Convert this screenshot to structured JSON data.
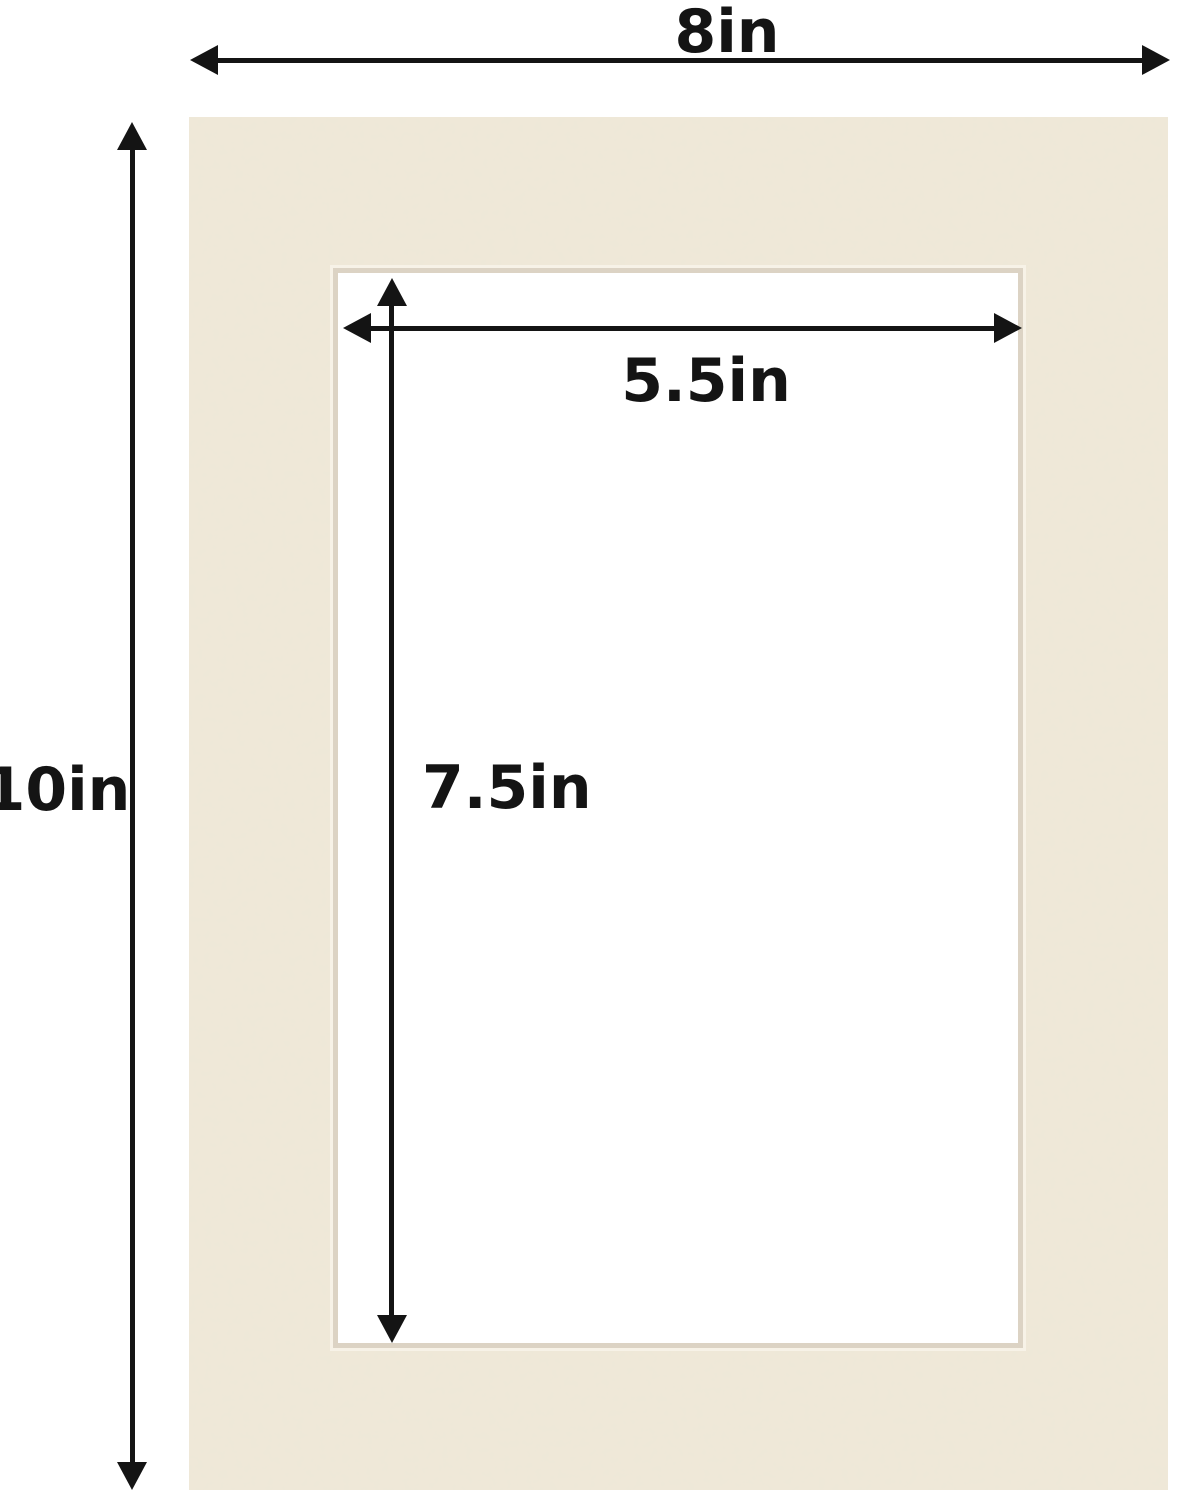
{
  "dimensions": {
    "outer_width_label": "8in",
    "outer_height_label": "10in",
    "opening_width_label": "5.5in",
    "opening_height_label": "7.5in"
  },
  "arrows": [
    {
      "name": "outer-width-arrow",
      "orientation": "horizontal",
      "measures": "mat outer width",
      "label": "8in"
    },
    {
      "name": "outer-height-arrow",
      "orientation": "vertical",
      "measures": "mat outer height",
      "label": "10in"
    },
    {
      "name": "opening-width-arrow",
      "orientation": "horizontal",
      "measures": "mat opening width",
      "label": "5.5in"
    },
    {
      "name": "opening-height-arrow",
      "orientation": "vertical",
      "measures": "mat opening height",
      "label": "7.5in"
    }
  ],
  "colors": {
    "background": "#ffffff",
    "mat": "#efe8d8",
    "mat_bevel_inner": "#dcd3c4",
    "mat_bevel_outer": "#f7f2e7",
    "opening": "#ffffff",
    "arrow": "#141414",
    "text": "#141414"
  }
}
